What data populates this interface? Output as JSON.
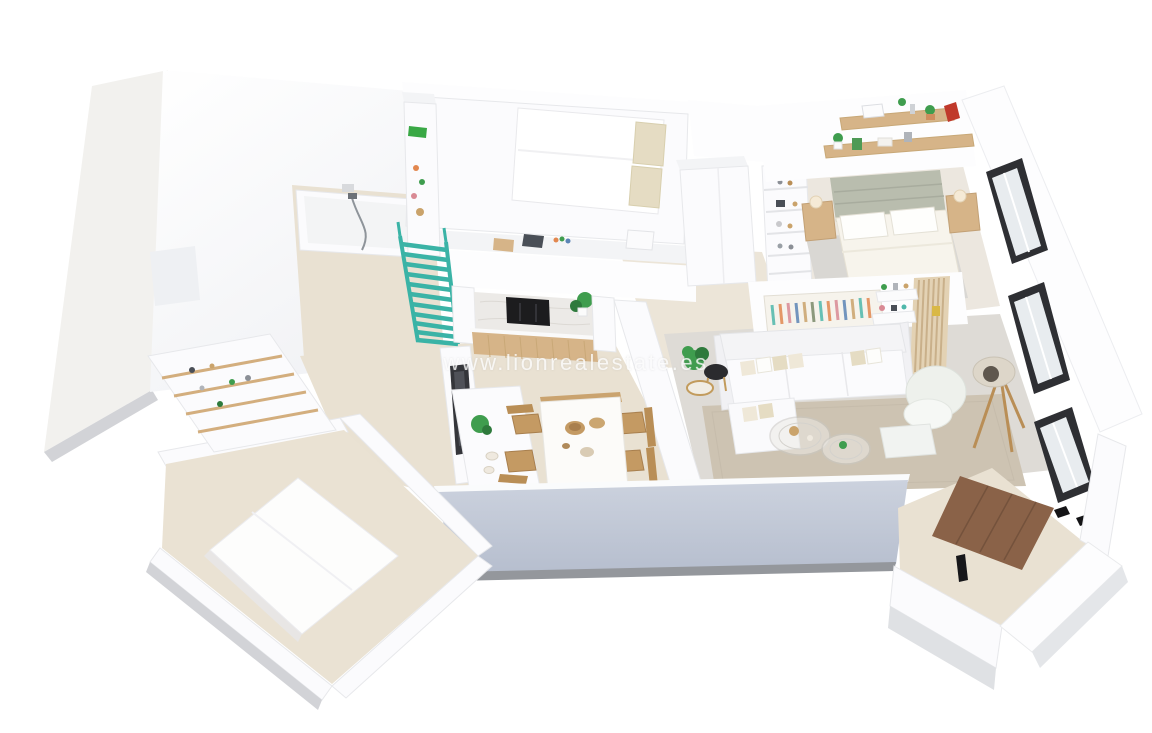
{
  "watermark": {
    "text": "www.lionrealestate.es"
  },
  "colors": {
    "background": "#ffffff",
    "wall_white": "#fcfcfd",
    "wall_shade": "#eef0f3",
    "south_wall": "#c0c8d6",
    "south_wall_edge": "#94979c",
    "terrace": "#f2f1ee",
    "slab_edge": "#d2d3d7",
    "floor_beige": "#e9e1d2",
    "floor_gray": "#dedbd6",
    "rug": "#cdc3b2",
    "carpet": "#eae2d3",
    "stairs_teal": "#3ab3a6",
    "wood_light": "#d6b488",
    "wood_mid": "#c49a63",
    "wood_dark": "#8a6248",
    "marble": "#eceae7",
    "tv_black": "#1c1c1e",
    "plant_green": "#3f9d4e",
    "sage": "#b9bdae",
    "pillow_beige": "#e5dcc3",
    "frame_dark": "#2e2f33",
    "lamp_wood": "#b98e56",
    "art_teal": "#4fb8ab",
    "art_orange": "#e2874f",
    "art_pink": "#d98a94",
    "art_blue": "#5b84b5",
    "red_book": "#c0392b"
  }
}
